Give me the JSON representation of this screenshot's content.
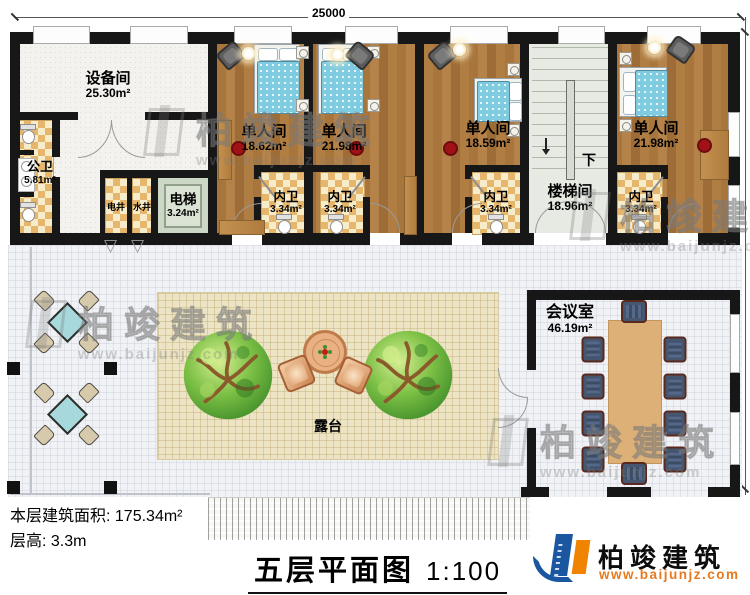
{
  "dimensions": {
    "width_mm": "25000",
    "height_mm": "17500"
  },
  "rooms": {
    "equipment": {
      "name": "设备间",
      "area": "25.30m²"
    },
    "public_wc": {
      "name": "公卫",
      "area": "5.81m²"
    },
    "elec_shaft": {
      "name": "电井"
    },
    "water_shaft": {
      "name": "水井"
    },
    "elevator": {
      "name": "电梯",
      "area": "3.24m²"
    },
    "single1": {
      "name": "单人间",
      "area": "18.62m²"
    },
    "single2": {
      "name": "单人间",
      "area": "21.98m²"
    },
    "single3": {
      "name": "单人间",
      "area": "18.59m²"
    },
    "single4": {
      "name": "单人间",
      "area": "21.98m²"
    },
    "bath1": {
      "name": "内卫",
      "area": "3.34m²"
    },
    "bath2": {
      "name": "内卫",
      "area": "3.34m²"
    },
    "bath3": {
      "name": "内卫",
      "area": "3.34m²"
    },
    "bath4": {
      "name": "内卫",
      "area": "3.34m²"
    },
    "stairwell": {
      "name": "楼梯间",
      "area": "18.96m²",
      "direction": "下"
    },
    "meeting": {
      "name": "会议室",
      "area": "46.19m²"
    },
    "terrace": {
      "name": "露台"
    }
  },
  "info": {
    "area_label": "本层建筑面积:",
    "area_value": "175.34m²",
    "height_label": "层高:",
    "height_value": "3.3m"
  },
  "title": {
    "text": "五层平面图",
    "scale": "1:100"
  },
  "brand": {
    "name": "柏竣建筑",
    "url": "www.baijunjz.com"
  },
  "watermark": {
    "name": "柏竣建筑",
    "url": "www.baijunjz.com"
  },
  "colors": {
    "wall": "#171717",
    "brand_blue": "#1a57a0",
    "brand_orange": "#f08300",
    "wood": "#ad7a41",
    "bed": "#7fcbe0"
  }
}
